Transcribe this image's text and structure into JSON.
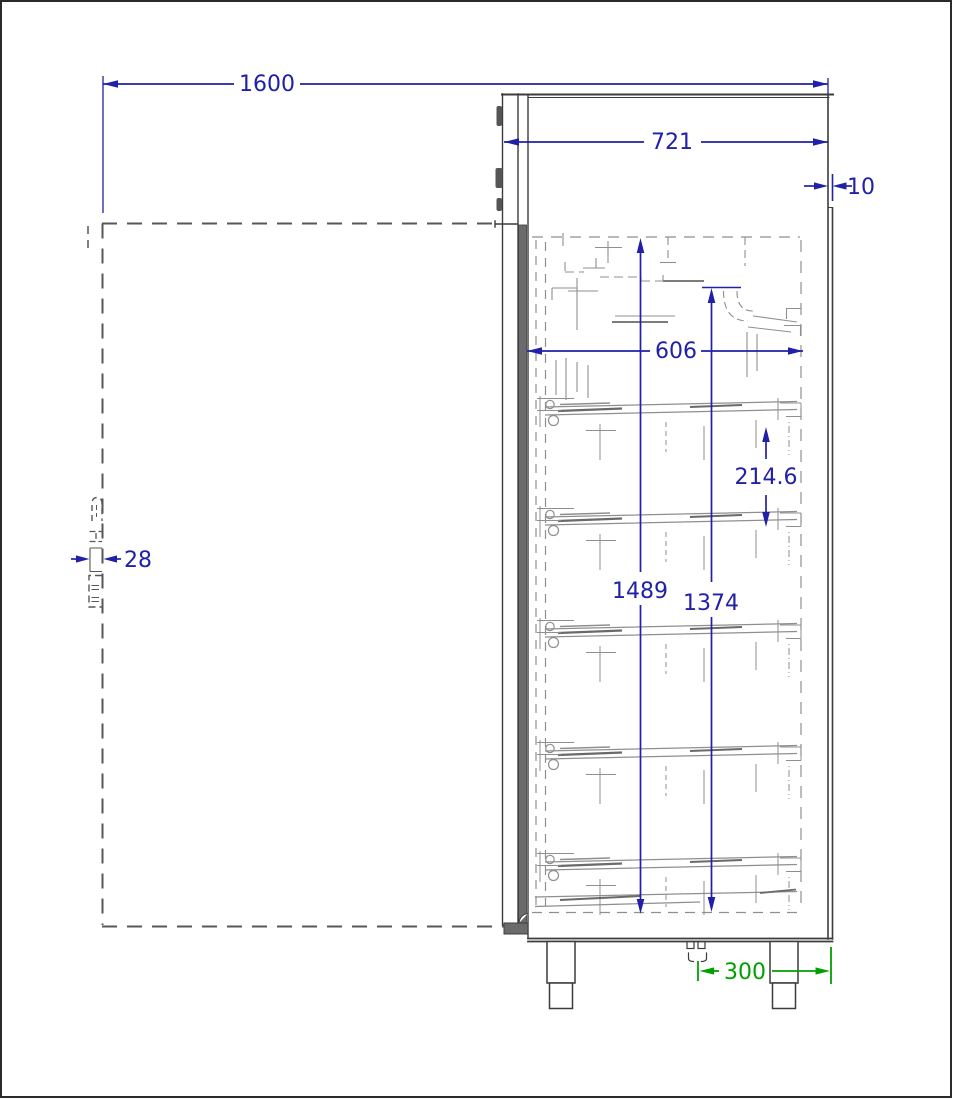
{
  "drawing": {
    "colors": {
      "dimension": "#2020a8",
      "alt_dimension": "#00a000",
      "outline": "#3c3c3c",
      "sketch": "#8f8f8f"
    },
    "dimensions": {
      "depth_door_open": "1600",
      "body_depth": "721",
      "back_clearance": "10",
      "interior_depth": "606",
      "shelf_spacing": "214.6",
      "interior_height_rear": "1489",
      "interior_height_front": "1374",
      "handle_protrusion": "28",
      "drain_to_back": "300"
    }
  }
}
